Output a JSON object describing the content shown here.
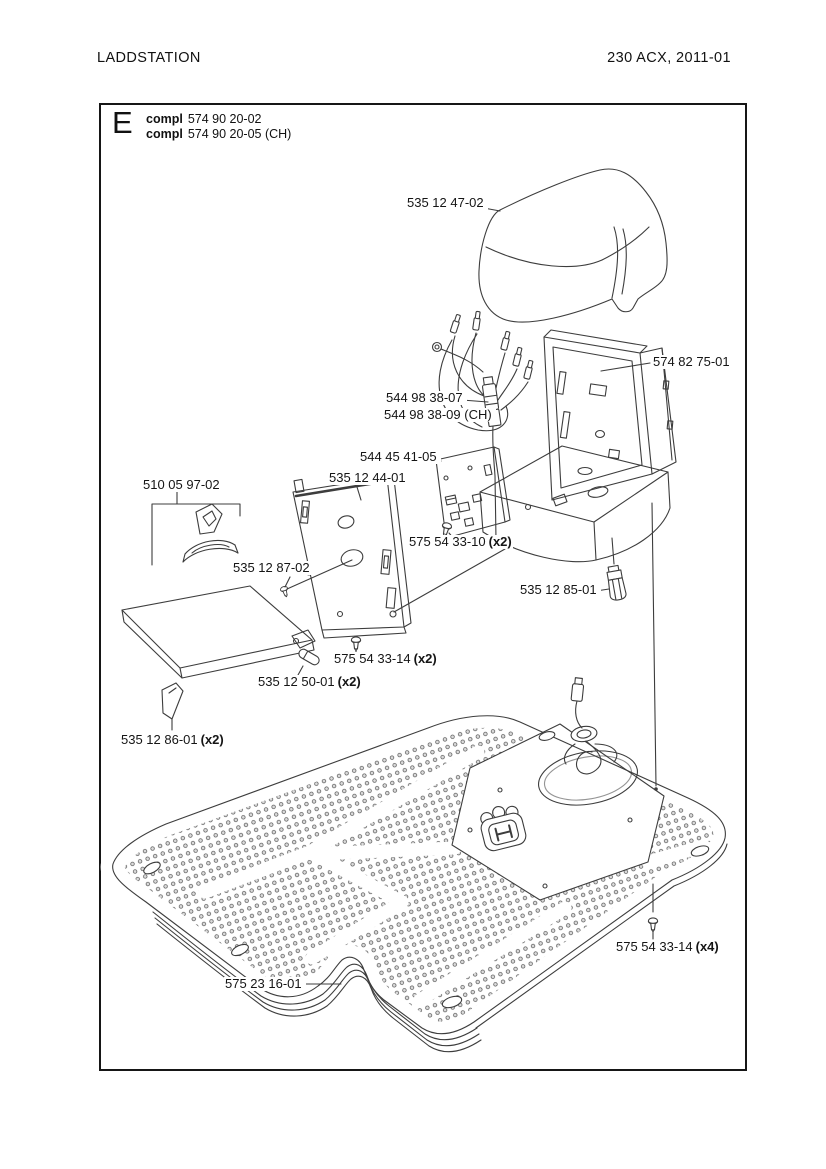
{
  "page": {
    "header_left": "LADDSTATION",
    "header_right": "230 ACX, 2011-01"
  },
  "diagram": {
    "section_letter": "E",
    "assemblies": [
      {
        "prefix": "compl",
        "number": "574 90 20-02"
      },
      {
        "prefix": "compl",
        "number": "574 90 20-05 (CH)"
      }
    ],
    "parts": [
      {
        "number": "535 12 47-02",
        "qty": ""
      },
      {
        "number": "574 82 75-01",
        "qty": ""
      },
      {
        "number": "544 98 38-07",
        "qty": ""
      },
      {
        "number": "544 98 38-09 (CH)",
        "qty": ""
      },
      {
        "number": "544 45 41-05",
        "qty": ""
      },
      {
        "number": "535 12 44-01",
        "qty": ""
      },
      {
        "number": "510 05 97-02",
        "qty": ""
      },
      {
        "number": "575 54 33-10",
        "qty": "(x2)"
      },
      {
        "number": "535 12 87-02",
        "qty": ""
      },
      {
        "number": "535 12 85-01",
        "qty": ""
      },
      {
        "number": "575 54 33-14",
        "qty": "(x2)"
      },
      {
        "number": "535 12 50-01",
        "qty": "(x2)"
      },
      {
        "number": "535 12 86-01",
        "qty": "(x2)"
      },
      {
        "number": "575 54 33-14",
        "qty": "(x4)"
      },
      {
        "number": "575 23 16-01",
        "qty": ""
      }
    ],
    "colors": {
      "ink": "#3d3d3d",
      "text": "#111111",
      "paper": "#ffffff"
    }
  }
}
